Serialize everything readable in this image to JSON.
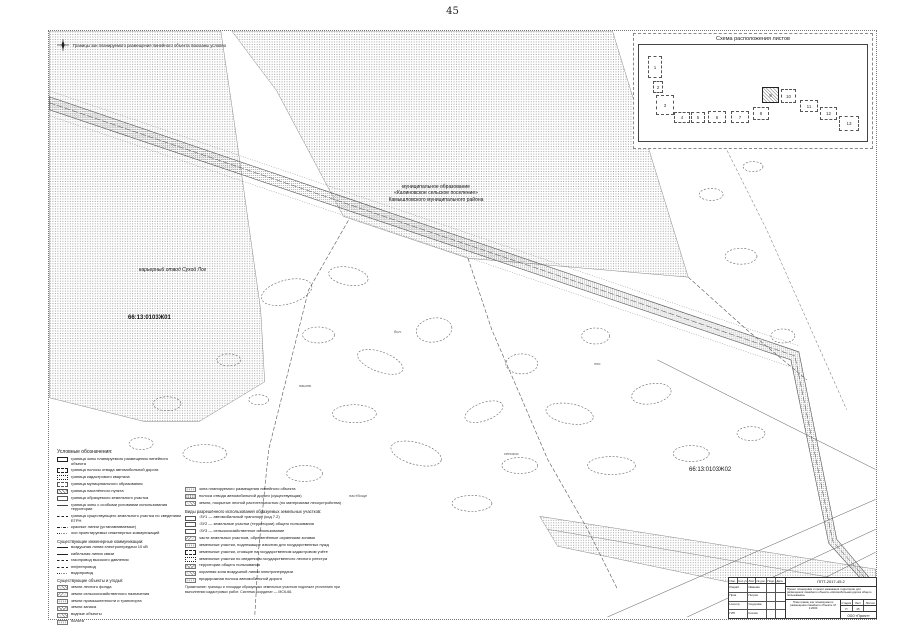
{
  "page": {
    "number": "45"
  },
  "map": {
    "north_note": "Границы зон планируемого размещения линейного объекта показаны условно",
    "labels": [
      {
        "text": "муниципальное образование\n«Калиновское сельское поселение»\nКамышловского муниципального района",
        "style": "left:292px;top:153px;width:190px;text-align:center;font-size:5px;"
      },
      {
        "text": "карьерный отвод Сухой Лог",
        "style": "left:90px;top:236px;width:120px;font-style:italic;font-size:5px;"
      },
      {
        "text": "66:13:0103Ж01",
        "style": "left:79px;top:284px;font-weight:bold;font-size:6px;"
      },
      {
        "text": "66:13:0103Ж02",
        "style": "left:640px;top:436px;font-size:6px;"
      },
      {
        "text": "пашня",
        "style": "left:250px;top:352px;font-size:4px;color:#555;"
      },
      {
        "text": "бол.",
        "style": "left:345px;top:298px;font-size:4px;color:#555;"
      },
      {
        "text": "сенокос",
        "style": "left:455px;top:420px;font-size:4px;color:#555;"
      },
      {
        "text": "пастбище",
        "style": "left:300px;top:462px;font-size:4px;color:#555;"
      },
      {
        "text": "лес",
        "style": "left:545px;top:330px;font-size:4px;color:#555;"
      }
    ]
  },
  "inset": {
    "title": "Схема расположения листов",
    "sheets": [
      {
        "n": "1",
        "style": "left:9px;top:11px;width:14px;height:22px;"
      },
      {
        "n": "2",
        "style": "left:14px;top:36px;width:10px;height:12px;"
      },
      {
        "n": "3",
        "style": "left:17px;top:50px;width:18px;height:20px;"
      },
      {
        "n": "4",
        "style": "left:35px;top:67px;width:16px;height:11px;"
      },
      {
        "n": "5",
        "style": "left:52px;top:67px;width:14px;height:11px;"
      },
      {
        "n": "6",
        "style": "left:69px;top:66px;width:18px;height:12px;"
      },
      {
        "n": "7",
        "style": "left:92px;top:66px;width:18px;height:12px;"
      },
      {
        "n": "8",
        "style": "left:114px;top:62px;width:16px;height:13px;"
      },
      {
        "n": "9",
        "style": "left:123px;top:42px;width:17px;height:16px;",
        "hl": "1"
      },
      {
        "n": "10",
        "style": "left:142px;top:44px;width:15px;height:14px;"
      },
      {
        "n": "11",
        "style": "left:161px;top:55px;width:18px;height:12px;"
      },
      {
        "n": "12",
        "style": "left:181px;top:62px;width:17px;height:13px;"
      },
      {
        "n": "13",
        "style": "left:200px;top:71px;width:20px;height:15px;"
      }
    ]
  },
  "legend": {
    "title": "Условные обозначения:",
    "col1": [
      {
        "kind": "item",
        "swatch": "box-solid",
        "label": "граница зоны планируемого размещения линейного объекта"
      },
      {
        "kind": "item",
        "swatch": "box-dash",
        "label": "граница полосы отвода автомобильной дороги"
      },
      {
        "kind": "item",
        "swatch": "box-dot",
        "label": "граница кадастрового квартала"
      },
      {
        "kind": "item",
        "swatch": "box-dashdot",
        "label": "граница муниципального образования"
      },
      {
        "kind": "item",
        "swatch": "box-hatch",
        "label": "граница населённого пункта"
      },
      {
        "kind": "item",
        "swatch": "box-open",
        "label": "граница образуемого земельного участка"
      },
      {
        "kind": "item",
        "swatch": "line-tick",
        "label": "граница зоны с особыми условиями использования территории"
      },
      {
        "kind": "item",
        "swatch": "line-dash",
        "label": "граница существующего земельного участка по сведениям ЕГРН"
      },
      {
        "kind": "item",
        "swatch": "line-dashdot",
        "label": "красные линии (устанавливаемые)"
      },
      {
        "kind": "item",
        "swatch": "line-dot",
        "label": "оси проектируемых инженерных коммуникаций"
      },
      {
        "kind": "heading",
        "swatch": "none",
        "label": "Существующие инженерные коммуникации:"
      },
      {
        "kind": "item",
        "swatch": "line-solid",
        "label": "воздушная линия электропередачи 10 кВ"
      },
      {
        "kind": "item",
        "swatch": "line-solid",
        "label": "кабельная линия связи"
      },
      {
        "kind": "item",
        "swatch": "line-dash",
        "label": "газопровод высокого давления"
      },
      {
        "kind": "item",
        "swatch": "line-dash",
        "label": "нефтепровод"
      },
      {
        "kind": "item",
        "swatch": "line-dot",
        "label": "водопровод"
      },
      {
        "kind": "heading",
        "swatch": "none",
        "label": "Существующие объекты и угодья:"
      },
      {
        "kind": "item",
        "swatch": "hatch-a",
        "label": "земли лесного фонда"
      },
      {
        "kind": "item",
        "swatch": "hatch-b",
        "label": "земли сельскохозяйственного назначения"
      },
      {
        "kind": "item",
        "swatch": "dots",
        "label": "земли промышленности и транспорта"
      },
      {
        "kind": "item",
        "swatch": "cross",
        "label": "земли запаса"
      },
      {
        "kind": "item",
        "swatch": "hatch-a",
        "label": "водные объекты"
      },
      {
        "kind": "item",
        "swatch": "dots",
        "label": "болота"
      }
    ],
    "col2": [
      {
        "kind": "item",
        "swatch": "dots",
        "label": "зона планируемого размещения линейного объекта"
      },
      {
        "kind": "item",
        "swatch": "stip",
        "label": "полоса отвода автомобильной дороги (существующая)"
      },
      {
        "kind": "item",
        "swatch": "hatch-a",
        "label": "земли, покрытые лесной растительностью (по материалам лесоустройства)"
      },
      {
        "kind": "heading",
        "swatch": "none",
        "label": "Виды разрешённого использования образуемых земельных участков:"
      },
      {
        "kind": "item",
        "swatch": "box-open",
        "label": ":ЗУ1 — автомобильный транспорт (код 7.2)"
      },
      {
        "kind": "item",
        "swatch": "box-open",
        "label": ":ЗУ2 — земельные участки (территории) общего пользования"
      },
      {
        "kind": "item",
        "swatch": "box-open",
        "label": ":ЗУ3 — сельскохозяйственное использование"
      },
      {
        "kind": "item",
        "swatch": "hatch-b",
        "label": "части земельных участков, обременённые охранными зонами"
      },
      {
        "kind": "item",
        "swatch": "dots",
        "label": "земельные участки, подлежащие изъятию для государственных нужд"
      },
      {
        "kind": "item",
        "swatch": "box-dash",
        "label": "земельные участки, стоящие на государственном кадастровом учёте"
      },
      {
        "kind": "item",
        "swatch": "box-dot",
        "label": "земельные участки по сведениям государственного лесного реестра"
      },
      {
        "kind": "item",
        "swatch": "cross",
        "label": "территории общего пользования"
      },
      {
        "kind": "item",
        "swatch": "hatch-a",
        "label": "охранная зона воздушной линии электропередачи"
      },
      {
        "kind": "item",
        "swatch": "dots",
        "label": "придорожная полоса автомобильной дороги"
      }
    ],
    "note": "Примечание: границы и площади образуемых земельных участков подлежат уточнению при выполнении кадастровых работ. Система координат — МСК-66."
  },
  "title_block": {
    "code": "ППТ-2017-45.2",
    "description": "Проект планировки и проект межевания территории для размещения линейного объекта «Автомобильная дорога общего пользования»",
    "sheet_name": "План границ зон планируемого размещения линейного объекта. М 1:2000",
    "cols": [
      "Изм.",
      "Кол.уч.",
      "Лист",
      "№ док.",
      "Подп.",
      "Дата"
    ],
    "rows": [
      {
        "role": "Разраб.",
        "name": "Иванова"
      },
      {
        "role": "Пров.",
        "name": "Петров"
      },
      {
        "role": "Н.контр.",
        "name": "Сидорова"
      },
      {
        "role": "ГИП",
        "name": "Козлов"
      }
    ],
    "stage_cols": [
      "Стадия",
      "Лист",
      "Листов"
    ],
    "stage_vals": [
      "П",
      "45",
      ""
    ],
    "company": "ООО «Проект»"
  }
}
